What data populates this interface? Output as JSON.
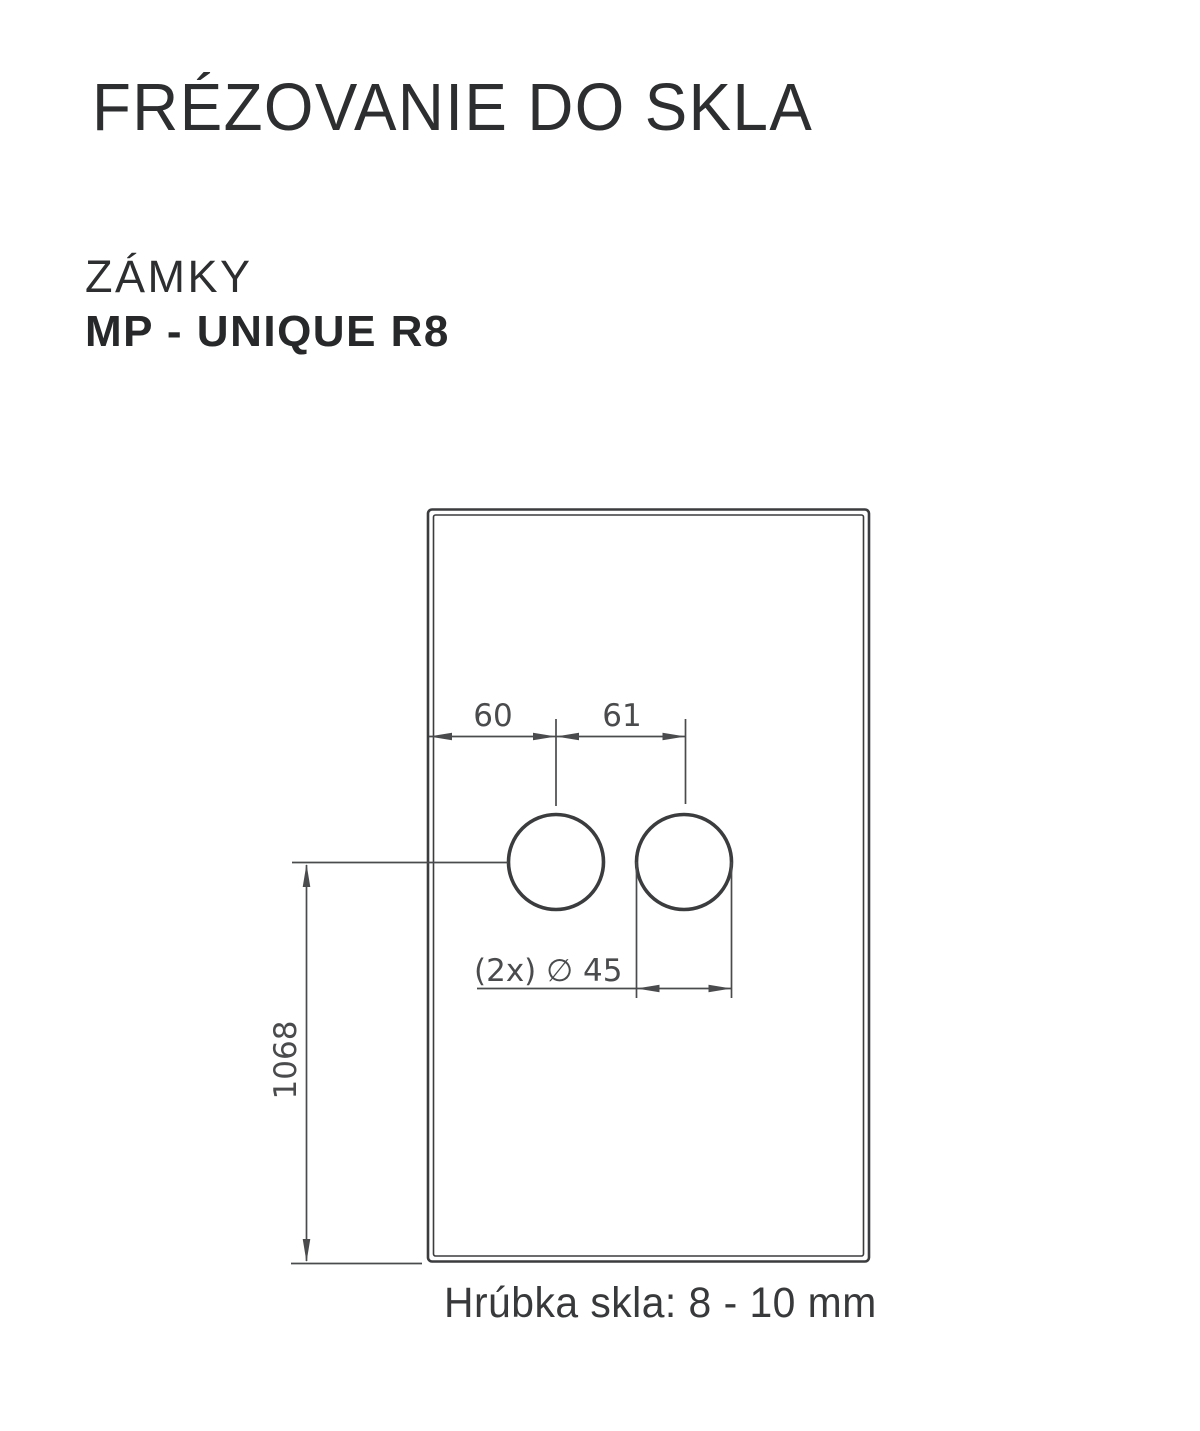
{
  "header": {
    "title": "FRÉZOVANIE DO SKLA",
    "category": "ZÁMKY",
    "product": "MP - UNIQUE R8"
  },
  "drawing": {
    "dim_edge_to_hole": "60",
    "dim_hole_spacing": "61",
    "hole_diameter_label": "(2x) ∅ 45",
    "dim_height": "1068",
    "ink_color": "#3b3c3e",
    "dim_line_color": "#4a4b4d"
  },
  "footer": {
    "thickness_note": "Hrúbka skla: 8 - 10 mm"
  }
}
